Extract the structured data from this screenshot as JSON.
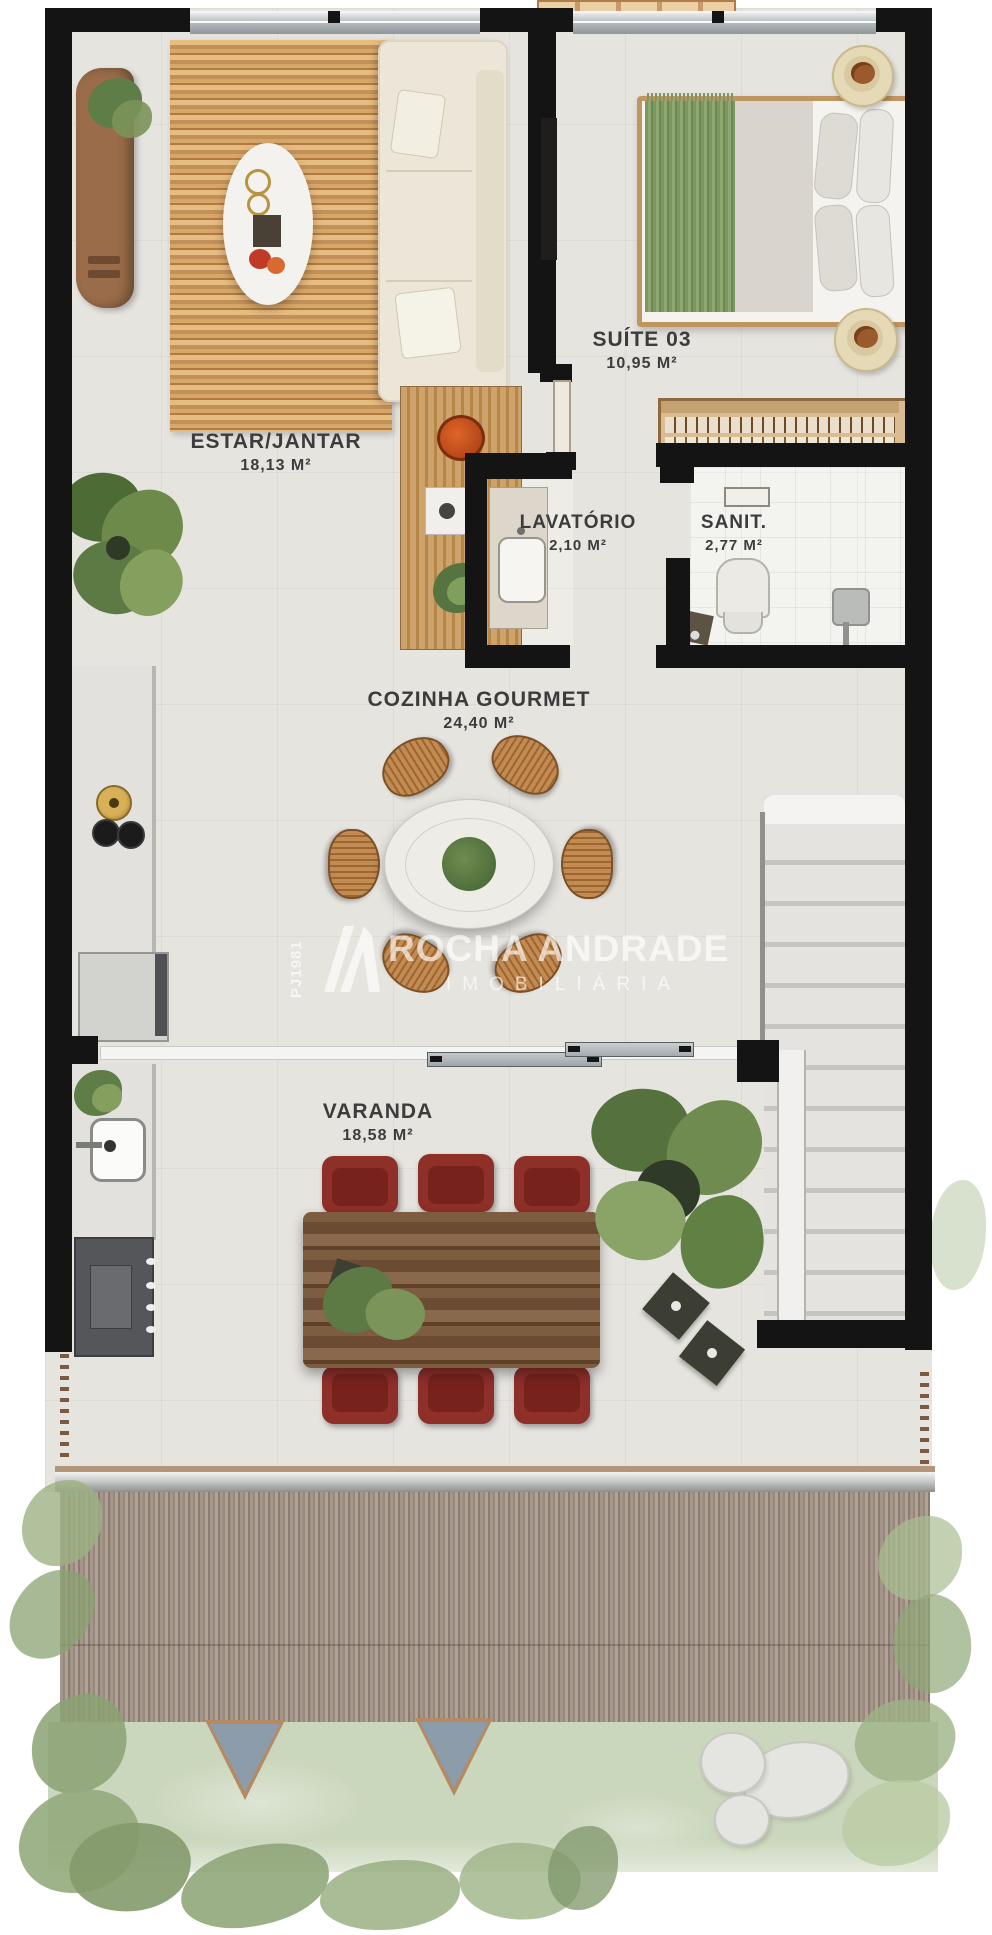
{
  "rooms": [
    {
      "id": "estar",
      "name": "ESTAR/JANTAR",
      "area": "18,13 M²"
    },
    {
      "id": "suite",
      "name": "SUÍTE 03",
      "area": "10,95 M²"
    },
    {
      "id": "lavatorio",
      "name": "LAVATÓRIO",
      "area": "2,10 M²"
    },
    {
      "id": "sanit",
      "name": "SANIT.",
      "area": "2,77 M²"
    },
    {
      "id": "cozinha",
      "name": "COZINHA GOURMET",
      "area": "24,40 M²"
    },
    {
      "id": "varanda",
      "name": "VARANDA",
      "area": "18,58 M²"
    }
  ],
  "watermark": {
    "registry": "PJ1981",
    "brand": "ROCHA ANDRADE",
    "subtitle": "IMOBILIÁRIA"
  },
  "colors": {
    "wall": "#141414",
    "floor": "#e6e4df",
    "wood_rug": "#cf9a5f",
    "bed_throw": "#86a069",
    "varanda_chair": "#8e2f28",
    "wicker": "#c38a51",
    "deck": "#a5968c",
    "grass": "#cbd7bd",
    "watermark": "#ffffff"
  }
}
